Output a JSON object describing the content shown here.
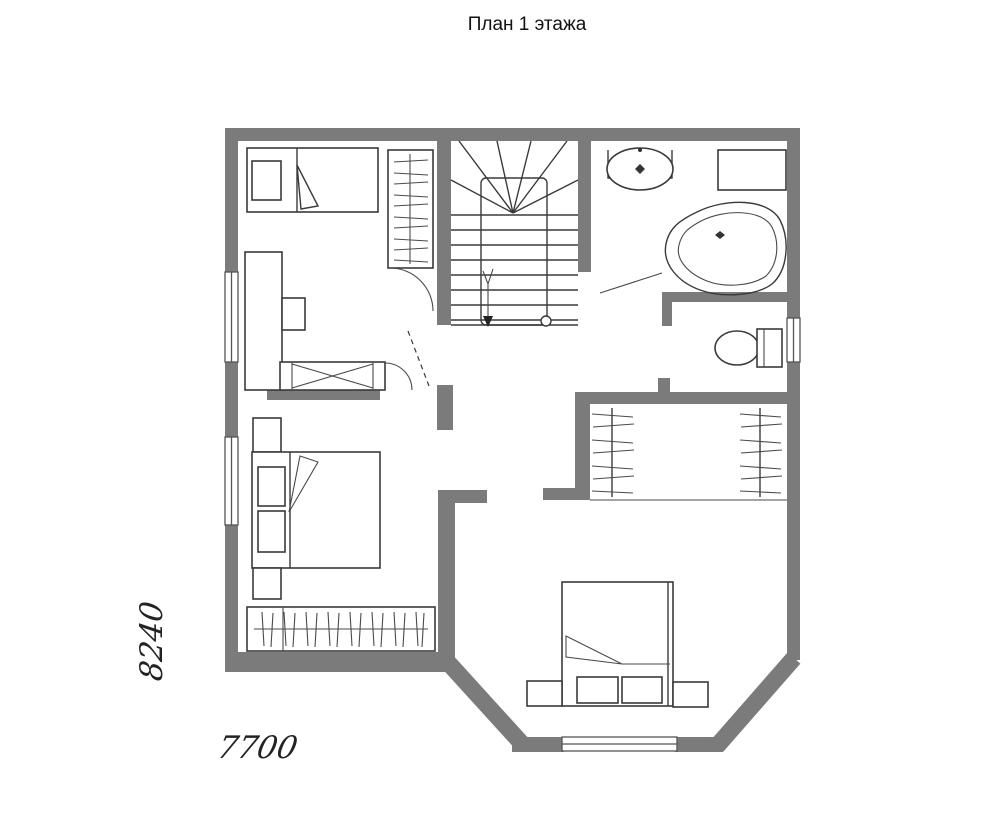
{
  "title": "План 1 этажа",
  "dimensions": {
    "vertical": "8240",
    "horizontal": "7700"
  },
  "colors": {
    "wall": "#7b7b7b",
    "line": "#3a3a3a",
    "background": "#ffffff"
  }
}
